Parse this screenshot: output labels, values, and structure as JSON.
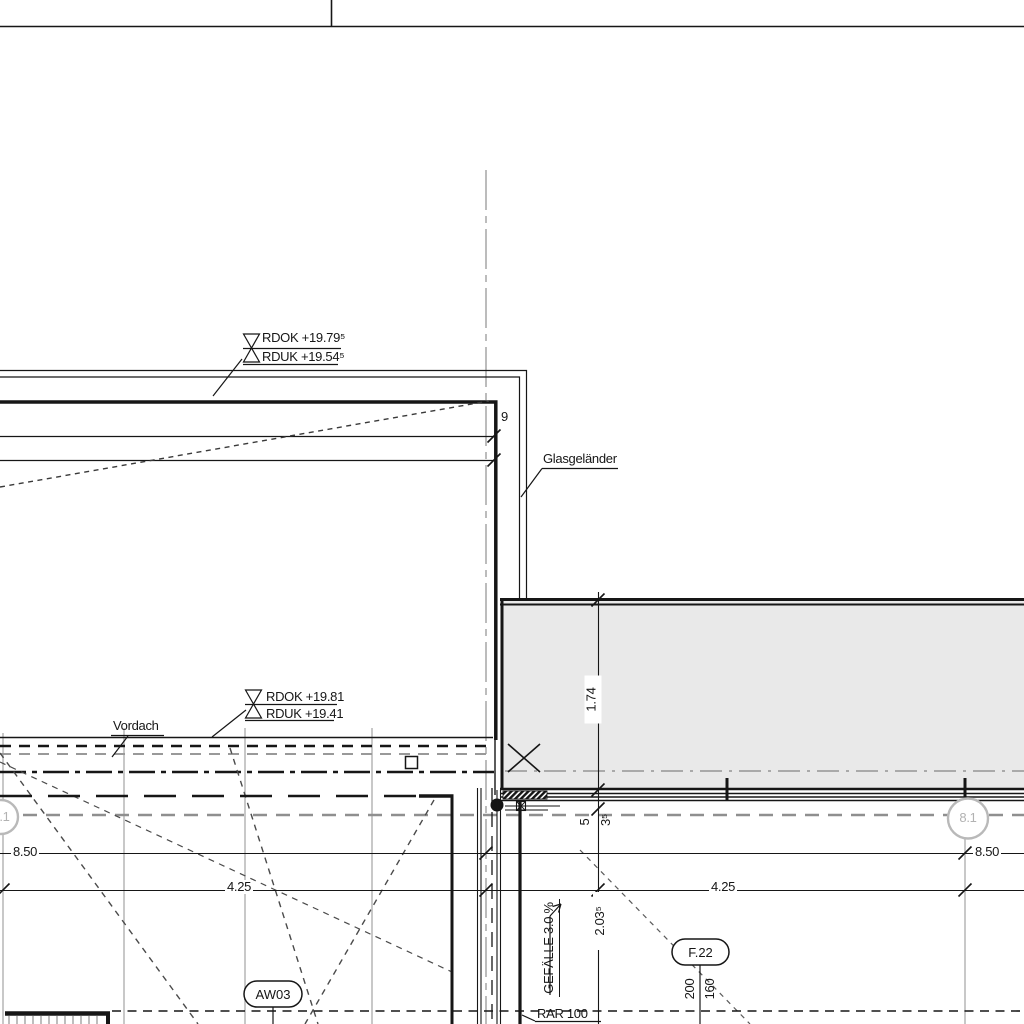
{
  "drawing": {
    "annotations": {
      "level_upper_line1": "RDOK +19.79⁵",
      "level_upper_line2": "RDUK +19.54⁵",
      "level_lower_line1": "RDOK +19.81",
      "level_lower_line2": "RDUK +19.41",
      "glass_railing": "Glasgeländer",
      "canopy": "Vordach",
      "slope": "GEFÄLLE 3.0 %",
      "drain": "RAR 100"
    },
    "tags": {
      "wall_tag": "AW03",
      "window_tag": "F.22",
      "grid_bubble_right": "8.1",
      "grid_bubble_left": "8.1"
    },
    "dimensions": {
      "span_left": "8.50",
      "span_right": "8.50",
      "half_left": "4.25",
      "half_right": "4.25",
      "balcony_depth": "1.74",
      "offset_small_a": "5",
      "offset_small_b": "3⁵",
      "railing_offset": "9",
      "window_width": "2.03⁵",
      "sill_a": "200",
      "sill_b": "160"
    },
    "colors": {
      "line_black": "#161616",
      "line_grey": "#b5b5b5",
      "balcony_fill": "#e9e9e9"
    }
  }
}
